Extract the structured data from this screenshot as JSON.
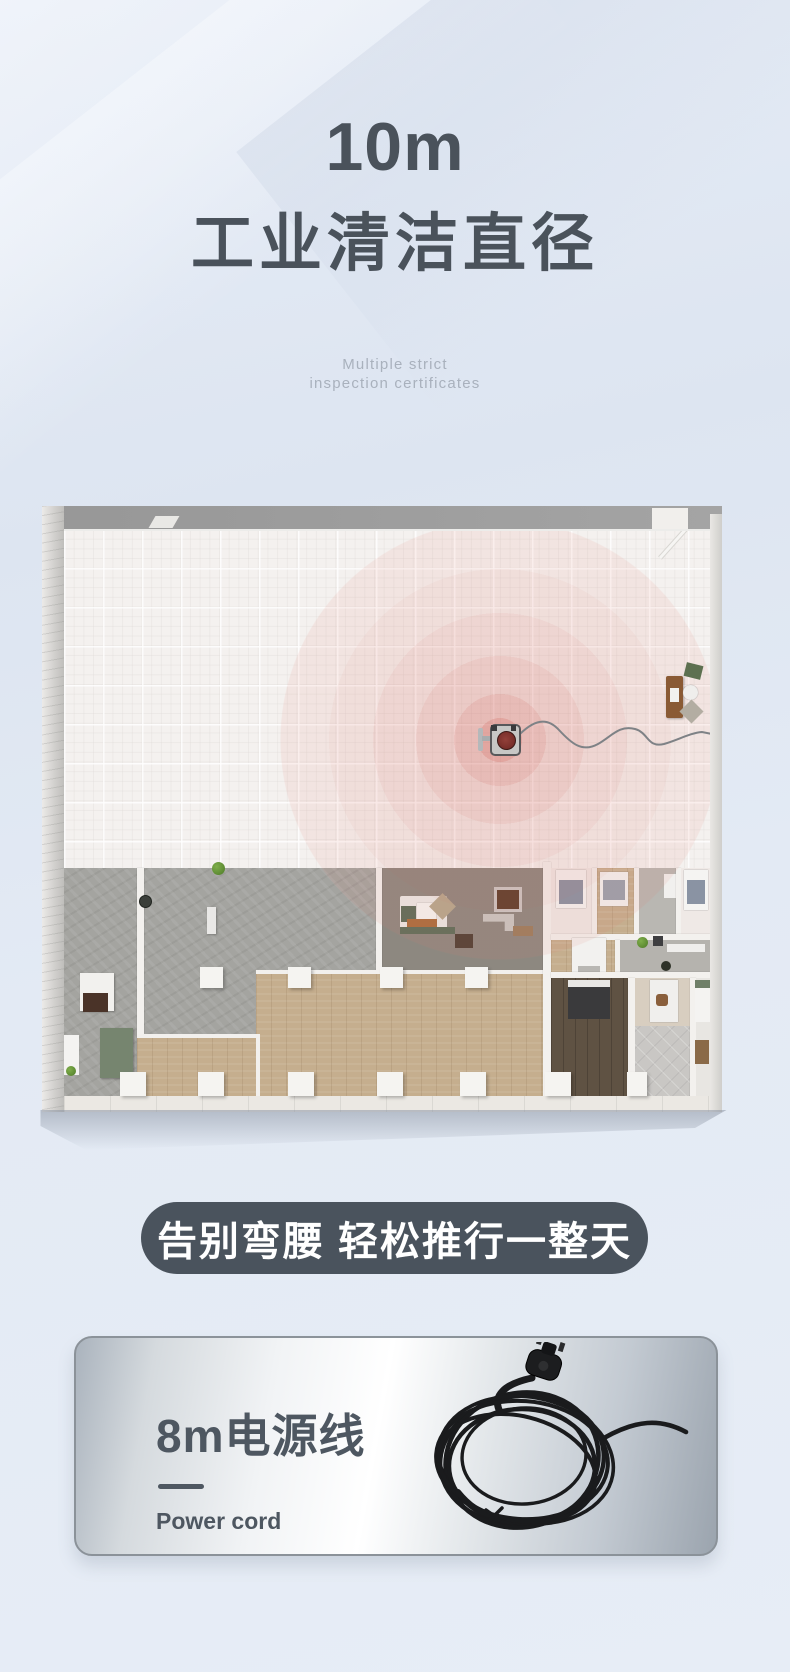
{
  "header": {
    "headline_value": "10m",
    "headline_title": "工业清洁直径",
    "subtitle_line1": "Multiple strict",
    "subtitle_line2": "inspection certificates"
  },
  "banner": {
    "text": "告别弯腰 轻松推行一整天"
  },
  "feature_card": {
    "title": "8m电源线",
    "subtitle": "Power cord"
  },
  "colors": {
    "title_text": "#4a525b",
    "radar_accent": "#cc4e44",
    "banner_background": "#4a535d",
    "card_text": "#4e5761",
    "page_background": "#e3eaf4"
  }
}
